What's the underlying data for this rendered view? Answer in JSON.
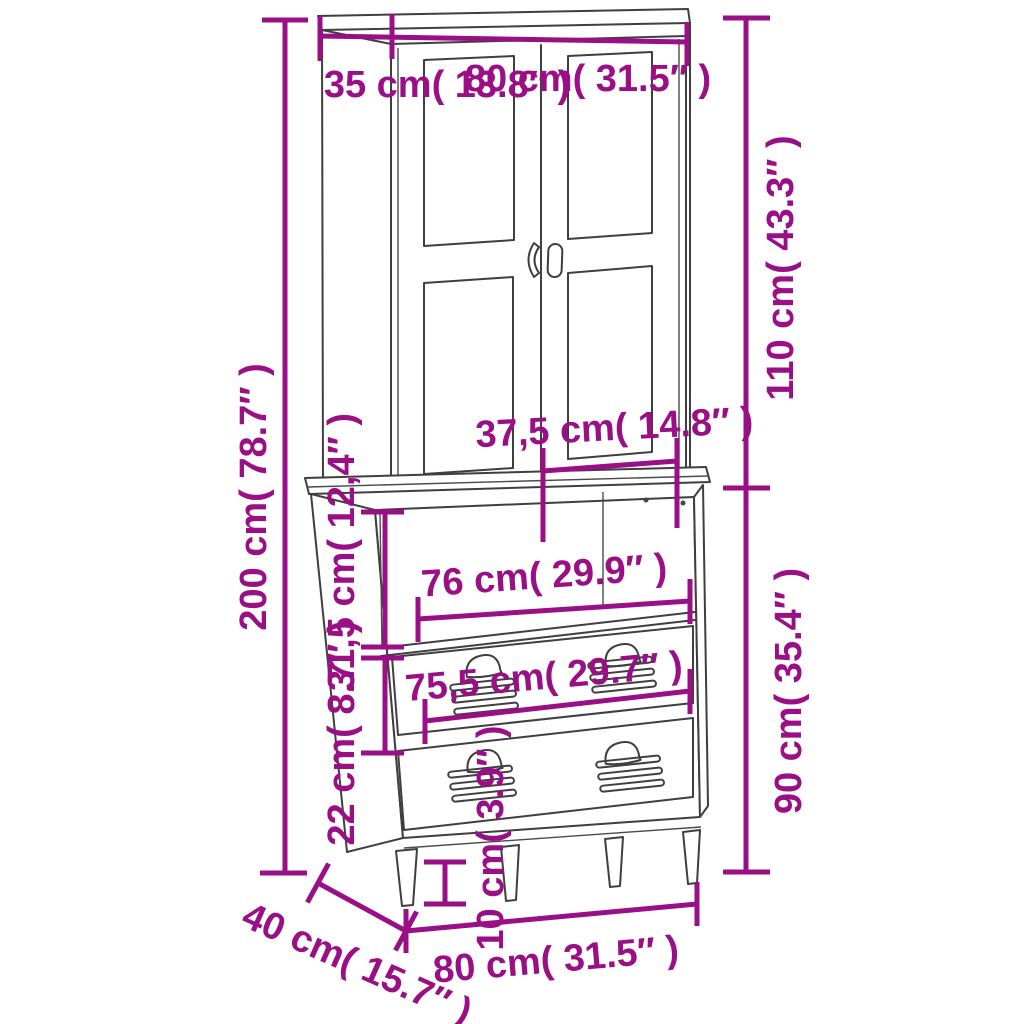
{
  "diagram": {
    "kind": "furniture-dimension-diagram",
    "subject": "highboard cabinet with two glass doors, open shelf compartment and two locker-style drawers on tapered legs",
    "background_color": "#FFFFFF",
    "drawing_line_color": "#3F3F3F",
    "dimension_color": "#9A0F86"
  },
  "dims": {
    "top_depth": {
      "cm": "35",
      "in": "13.8",
      "label": "35 cm( 13.8″ )"
    },
    "top_width": {
      "cm": "80",
      "in": "31.5",
      "label": "80 cm( 31.5″ )"
    },
    "total_height": {
      "cm": "200",
      "in": "78.7",
      "label": "200 cm( 78.7″ )"
    },
    "upper_height": {
      "cm": "110",
      "in": "43.3",
      "label": "110 cm( 43.3″ )"
    },
    "door_width": {
      "cm": "37,5",
      "in": "14.8",
      "label": "37,5 cm( 14.8″ )"
    },
    "open_shelf_height": {
      "cm": "31,5",
      "in": "12,4",
      "label": "31,5 cm( 12,4″ )"
    },
    "shelf_inner_width": {
      "cm": "76",
      "in": "29.9",
      "label": "76 cm( 29.9″ )"
    },
    "drawer_width": {
      "cm": "75,5",
      "in": "29.7",
      "label": "75,5 cm( 29.7″ )"
    },
    "drawer_height": {
      "cm": "22",
      "in": "8.7",
      "label": "22 cm( 8.7″ )"
    },
    "lower_height": {
      "cm": "90",
      "in": "35.4",
      "label": "90 cm( 35.4″ )"
    },
    "leg_height": {
      "cm": "10",
      "in": "3.9",
      "label": "10 cm( 3.9″ )"
    },
    "base_depth": {
      "cm": "40",
      "in": "15.7",
      "label": "40 cm( 15.7″ )"
    },
    "base_width": {
      "cm": "80",
      "in": "31.5",
      "label": "80 cm( 31.5″ )"
    }
  }
}
